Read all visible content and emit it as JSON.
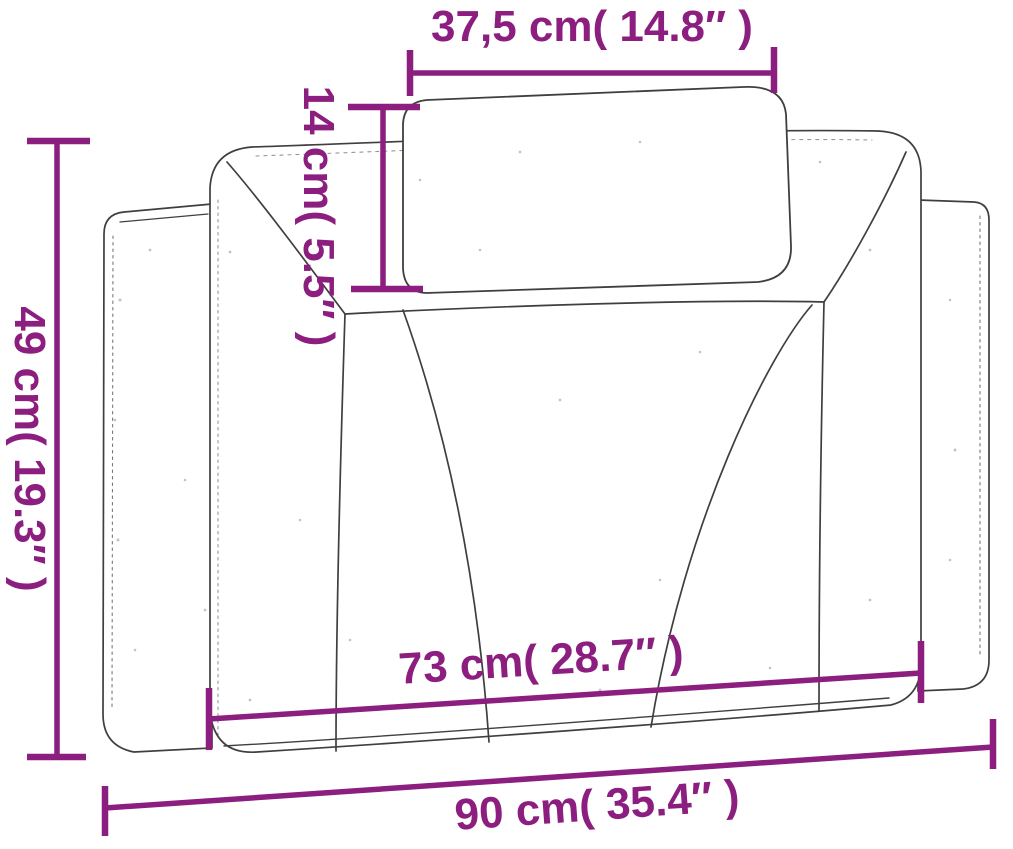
{
  "diagram": {
    "subject": "headboard-cushion-dimension-drawing",
    "dimension_labels": {
      "top_width": "37,5 cm( 14.8″ )",
      "pillow_height": "14 cm( 5.5″ )",
      "overall_height": "49 cm( 19.3″ )",
      "inner_width": "73 cm( 28.7″ )",
      "overall_width": "90 cm( 35.4″ )"
    },
    "measurements": [
      {
        "id": "top_width",
        "cm": "37,5",
        "inches": "14.8"
      },
      {
        "id": "pillow_height",
        "cm": "14",
        "inches": "5.5"
      },
      {
        "id": "overall_height",
        "cm": "49",
        "inches": "19.3"
      },
      {
        "id": "inner_width",
        "cm": "73",
        "inches": "28.7"
      },
      {
        "id": "overall_width",
        "cm": "90",
        "inches": "35.4"
      }
    ],
    "colors": {
      "dimension_accent": "#8B1E7E",
      "sketch_line": "#3F3F3F",
      "background": "#FFFFFF"
    }
  }
}
